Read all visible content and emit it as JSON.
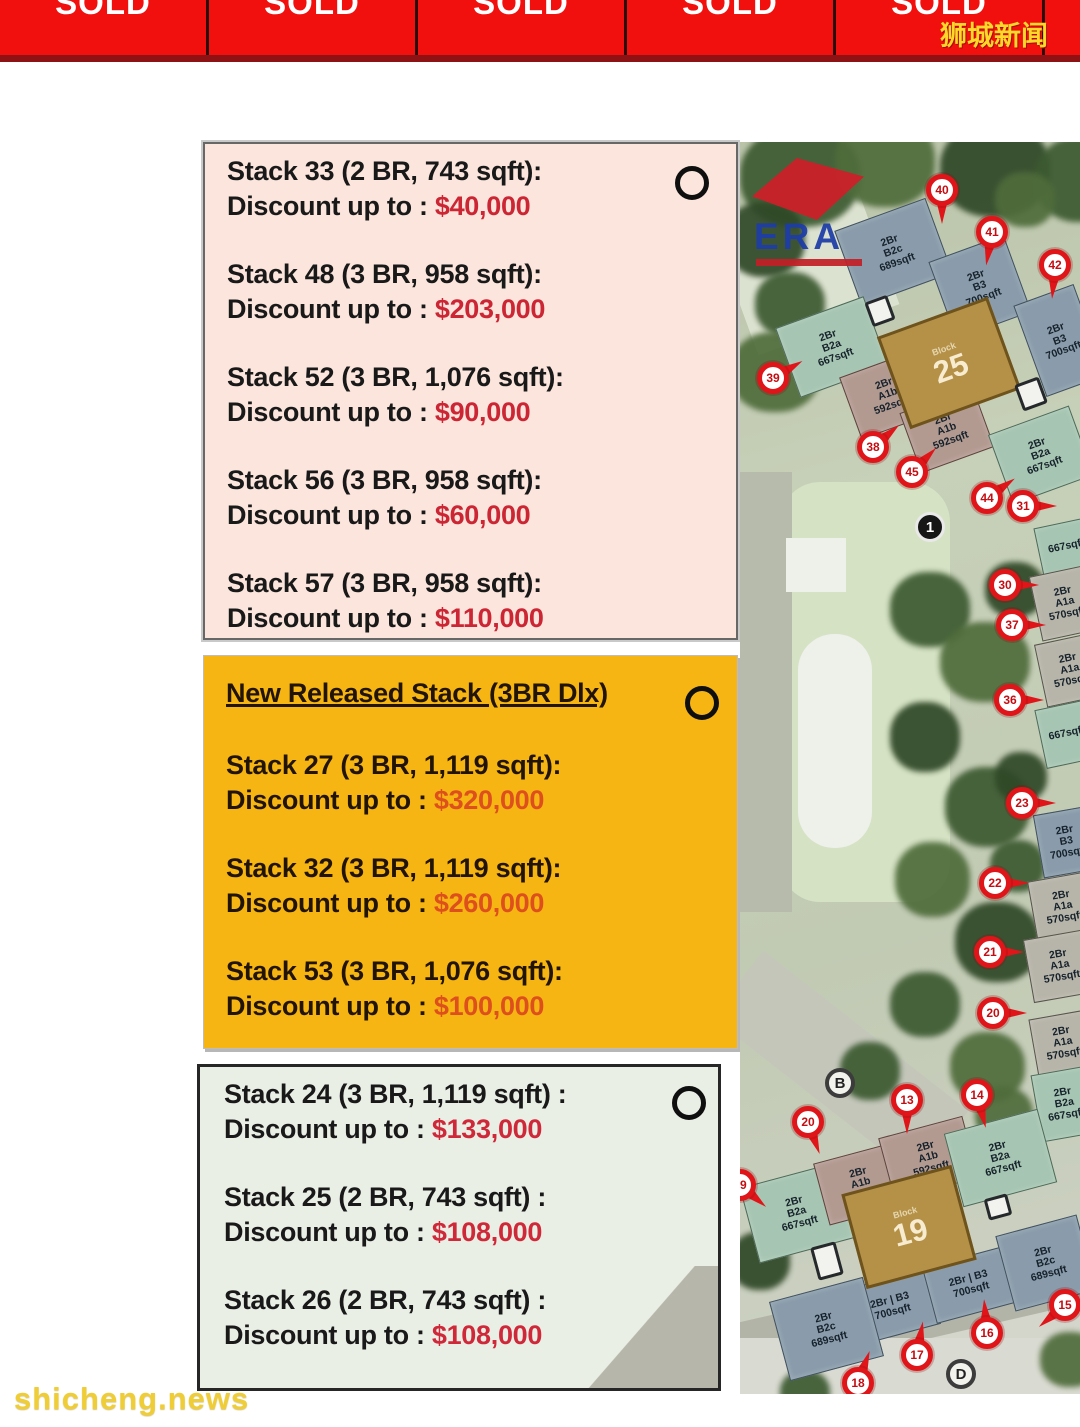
{
  "banner": {
    "sold_label": "SOLD",
    "site_label": "狮城新闻"
  },
  "boxes": {
    "discount_prefix": "Discount up to : ",
    "resale": {
      "items": [
        {
          "title": "Stack 33 (2 BR, 743 sqft):",
          "amount": "$40,000"
        },
        {
          "title": "Stack 48 (3 BR, 958 sqft):",
          "amount": "$203,000"
        },
        {
          "title": "Stack 52 (3 BR, 1,076 sqft):",
          "amount": "$90,000"
        },
        {
          "title": "Stack 56 (3 BR, 958 sqft):",
          "amount": "$60,000"
        },
        {
          "title": "Stack 57 (3 BR, 958 sqft):",
          "amount": "$110,000"
        }
      ]
    },
    "new_release": {
      "heading": "New Released Stack (3BR Dlx)",
      "items": [
        {
          "title": "Stack 27 (3 BR, 1,119 sqft):",
          "amount": "$320,000"
        },
        {
          "title": "Stack 32 (3 BR, 1,119 sqft):",
          "amount": "$260,000"
        },
        {
          "title": "Stack 53 (3 BR, 1,076 sqft):",
          "amount": "$100,000"
        }
      ]
    },
    "block19": {
      "items": [
        {
          "title": "Stack 24 (3 BR, 1,119 sqft) :",
          "amount": "$133,000"
        },
        {
          "title": "Stack 25 (2 BR, 743 sqft) :",
          "amount": "$108,000"
        },
        {
          "title": "Stack 26 (2 BR, 743 sqft) :",
          "amount": "$108,000"
        }
      ]
    }
  },
  "map": {
    "era_label": "ERA",
    "block_word": "Block",
    "centers": [
      {
        "num": "25",
        "word": "Block",
        "x": 150,
        "y": 172,
        "w": 112,
        "h": 92,
        "rot": -20
      },
      {
        "num": "19",
        "word": "Block",
        "x": 112,
        "y": 1036,
        "w": 108,
        "h": 92,
        "rot": -15
      }
    ],
    "blocks": [
      {
        "label": "2Br\nB2c\n689sqft",
        "x": 105,
        "y": 70,
        "w": 95,
        "h": 78,
        "rot": -20,
        "cls": "slate"
      },
      {
        "label": "2Br\nB3\n700sqft",
        "x": 200,
        "y": 104,
        "w": 78,
        "h": 80,
        "rot": -20,
        "cls": "slate"
      },
      {
        "label": "2Br\nB3\n700sqft",
        "x": 288,
        "y": 150,
        "w": 62,
        "h": 95,
        "rot": -20,
        "cls": "slate"
      },
      {
        "label": "2Br\nB2a\n667sqft",
        "x": 45,
        "y": 168,
        "w": 92,
        "h": 72,
        "rot": -20,
        "cls": "teal"
      },
      {
        "label": "2Br\nA1b\n592sqft",
        "x": 108,
        "y": 220,
        "w": 78,
        "h": 64,
        "rot": -20,
        "cls": "mauve"
      },
      {
        "label": "2Br\nA1b\n592sqft",
        "x": 168,
        "y": 256,
        "w": 76,
        "h": 62,
        "rot": -20,
        "cls": "mauve"
      },
      {
        "label": "2Br\nB2a\n667sqft",
        "x": 258,
        "y": 276,
        "w": 84,
        "h": 72,
        "rot": -20,
        "cls": "teal"
      },
      {
        "label": "667sqft",
        "x": 298,
        "y": 380,
        "w": 55,
        "h": 48,
        "rot": -12,
        "cls": "teal"
      },
      {
        "label": "2Br\nA1a\n570sqft",
        "x": 295,
        "y": 428,
        "w": 58,
        "h": 64,
        "rot": -12,
        "cls": "gray"
      },
      {
        "label": "2Br\nA1a\n570sqft",
        "x": 300,
        "y": 496,
        "w": 58,
        "h": 62,
        "rot": -12,
        "cls": "gray"
      },
      {
        "label": "667sqft",
        "x": 300,
        "y": 562,
        "w": 52,
        "h": 58,
        "rot": -12,
        "cls": "teal"
      },
      {
        "label": "2Br\nB3\n700sqft",
        "x": 298,
        "y": 668,
        "w": 55,
        "h": 62,
        "rot": -10,
        "cls": "slate"
      },
      {
        "label": "2Br\nA1a\n570sqft",
        "x": 292,
        "y": 734,
        "w": 60,
        "h": 60,
        "rot": -10,
        "cls": "gray"
      },
      {
        "label": "2Br\nA1a\n570sqft",
        "x": 288,
        "y": 792,
        "w": 62,
        "h": 62,
        "rot": -10,
        "cls": "gray"
      },
      {
        "label": "2Br\nA1a\n570sqft",
        "x": 293,
        "y": 872,
        "w": 58,
        "h": 56,
        "rot": -10,
        "cls": "gray"
      },
      {
        "label": "2Br\nB2a\n667sqft",
        "x": 296,
        "y": 928,
        "w": 55,
        "h": 66,
        "rot": -10,
        "cls": "teal"
      },
      {
        "label": "2Br\nB2a\n667sqft",
        "x": 8,
        "y": 1032,
        "w": 96,
        "h": 76,
        "rot": -15,
        "cls": "teal"
      },
      {
        "label": "2Br\nA1b\n592sqft",
        "x": 80,
        "y": 1010,
        "w": 80,
        "h": 62,
        "rot": -15,
        "cls": "mauve"
      },
      {
        "label": "2Br\nA1b\n592sqft",
        "x": 145,
        "y": 984,
        "w": 85,
        "h": 62,
        "rot": -15,
        "cls": "mauve"
      },
      {
        "label": "2Br\nB2a\n667sqft",
        "x": 212,
        "y": 978,
        "w": 95,
        "h": 74,
        "rot": -15,
        "cls": "teal"
      },
      {
        "label": "2Br | B3\n700sqft",
        "x": 108,
        "y": 1136,
        "w": 85,
        "h": 56,
        "rot": -15,
        "cls": "slate"
      },
      {
        "label": "2Br | B3\n700sqft",
        "x": 188,
        "y": 1114,
        "w": 82,
        "h": 56,
        "rot": -15,
        "cls": "slate"
      },
      {
        "label": "2Br\nB2c\n689sqft",
        "x": 264,
        "y": 1082,
        "w": 82,
        "h": 76,
        "rot": -15,
        "cls": "slate"
      },
      {
        "label": "2Br\nB2c\n689sqft",
        "x": 38,
        "y": 1146,
        "w": 95,
        "h": 80,
        "rot": -15,
        "cls": "slate"
      }
    ],
    "pins": [
      {
        "n": "40",
        "x": 186,
        "y": 32,
        "rot": 90
      },
      {
        "n": "41",
        "x": 236,
        "y": 74,
        "rot": 100
      },
      {
        "n": "42",
        "x": 299,
        "y": 107,
        "rot": 95
      },
      {
        "n": "39",
        "x": 17,
        "y": 220,
        "rot": -30
      },
      {
        "n": "38",
        "x": 117,
        "y": 289,
        "rot": -40
      },
      {
        "n": "45",
        "x": 156,
        "y": 314,
        "rot": -45
      },
      {
        "n": "44",
        "x": 231,
        "y": 340,
        "rot": -35
      },
      {
        "n": "31",
        "x": 267,
        "y": 348,
        "rot": 0
      },
      {
        "n": "30",
        "x": 249,
        "y": 427,
        "rot": 0
      },
      {
        "n": "37",
        "x": 256,
        "y": 467,
        "rot": 0
      },
      {
        "n": "36",
        "x": 254,
        "y": 542,
        "rot": 0
      },
      {
        "n": "23",
        "x": 266,
        "y": 645,
        "rot": 0
      },
      {
        "n": "22",
        "x": 239,
        "y": 725,
        "rot": 0
      },
      {
        "n": "21",
        "x": 234,
        "y": 794,
        "rot": 0
      },
      {
        "n": "20",
        "x": 237,
        "y": 855,
        "rot": 0
      },
      {
        "n": "13",
        "x": 151,
        "y": 942,
        "rot": 90
      },
      {
        "n": "14",
        "x": 221,
        "y": 937,
        "rot": 75
      },
      {
        "n": "20",
        "x": 52,
        "y": 964,
        "rot": 70
      },
      {
        "n": "19",
        "x": -16,
        "y": 1027,
        "rot": 40
      },
      {
        "n": "15",
        "x": 309,
        "y": 1147,
        "rot": 140
      },
      {
        "n": "16",
        "x": 231,
        "y": 1175,
        "rot": -95
      },
      {
        "n": "17",
        "x": 161,
        "y": 1197,
        "rot": -80
      },
      {
        "n": "18",
        "x": 102,
        "y": 1225,
        "rot": -70
      }
    ],
    "circle_markers": [
      {
        "n": "1",
        "x": 175,
        "y": 370,
        "cls": "dark"
      },
      {
        "n": "B",
        "x": 85,
        "y": 926,
        "cls": "light"
      },
      {
        "n": "D",
        "x": 206,
        "y": 1217,
        "cls": "light"
      }
    ]
  },
  "watermark": "shicheng.news"
}
